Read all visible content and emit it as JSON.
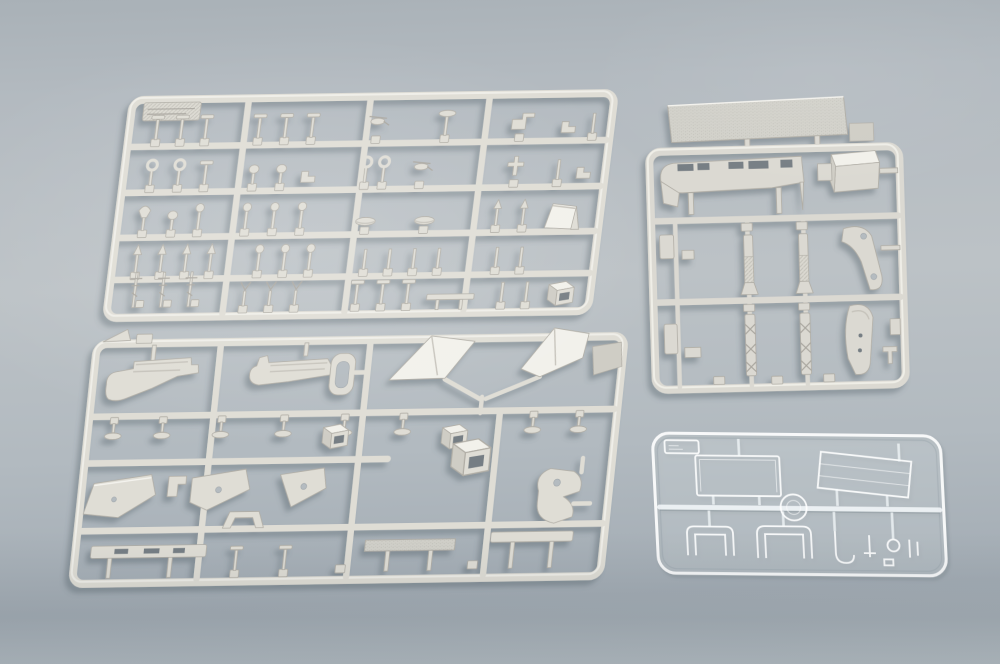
{
  "scene": {
    "title": "Plastic model kit sprues photo",
    "description": "Top-down photograph of four injection-moulded styrene sprues (parts frames) for a warship model kit on a blue-grey surface: a large sprue of small fittings at top left, a large sprue of superstructure parts at bottom left, a sprue of deck and hull parts at top right, and a small transparent clear-parts sprue at bottom right.",
    "background": {
      "top": "#a9b1b7",
      "middle": "#bcc2c6",
      "bottom": "#a3acb4"
    },
    "colors": {
      "plastic": "#dfddd5",
      "plastic_hi": "#f2f1eb",
      "plastic_mid": "#cfcdc5",
      "plastic_shadow": "#b2afa7",
      "outline": "#b0ada5",
      "opening": "#767e84",
      "hole": "#b4bbc0",
      "clear_stroke": "rgba(255,255,255,0.9)"
    },
    "sprues": [
      {
        "id": "A",
        "name": "small fittings sprue",
        "position": "top left",
        "material": "grey styrene",
        "layout": "5 rows x 4 columns of small posts, masts, balls and fittings",
        "parts_approx": 55,
        "label_tab": true
      },
      {
        "id": "B",
        "name": "superstructure parts sprue",
        "position": "bottom left",
        "material": "grey styrene",
        "notable_parts": [
          "two large superstructure side pieces",
          "two bright funnel wedges joined in a V",
          "pointed bow wedge",
          "flat triangular panels with holes",
          "long deck strips"
        ]
      },
      {
        "id": "C",
        "name": "deck and hull parts sprue",
        "position": "top right",
        "material": "grey styrene",
        "notable_parts": [
          "textured deck plank attached above the frame",
          "slotted hull side piece",
          "box structure",
          "two finned launcher parts",
          "two lattice mast parts",
          "curved davit with holes",
          "ship's boat hull"
        ]
      },
      {
        "id": "D",
        "name": "clear parts sprue",
        "position": "bottom right",
        "material": "transparent styrene",
        "notable_parts": [
          "rectangular window panel",
          "angled bridge glazing panel",
          "two windscreen frames",
          "round port",
          "hook piece"
        ],
        "label_tab": true
      }
    ]
  },
  "sprue1": {
    "rows": [
      {
        "y": 47,
        "items": [
          {
            "x": 28,
            "g": "tee"
          },
          {
            "x": 53,
            "g": "tee"
          },
          {
            "x": 78,
            "g": "tee"
          },
          {
            "x": 132,
            "g": "tee"
          },
          {
            "x": 159,
            "g": "tee"
          },
          {
            "x": 186,
            "g": "tee"
          },
          {
            "x": 252,
            "g": "heli"
          },
          {
            "x": 322,
            "g": "oval"
          },
          {
            "x": 398,
            "g": "gun"
          },
          {
            "x": 447,
            "g": "zig"
          },
          {
            "x": 472,
            "g": "post"
          }
        ]
      },
      {
        "y": 93,
        "items": [
          {
            "x": 28,
            "g": "ring"
          },
          {
            "x": 56,
            "g": "ring"
          },
          {
            "x": 83,
            "g": "tee"
          },
          {
            "x": 132,
            "g": "blob"
          },
          {
            "x": 160,
            "g": "blob"
          },
          {
            "x": 188,
            "g": "zig"
          },
          {
            "x": 246,
            "g": "ring"
          },
          {
            "x": 264,
            "g": "ring"
          },
          {
            "x": 302,
            "g": "heli"
          },
          {
            "x": 398,
            "g": "cross"
          },
          {
            "x": 442,
            "g": "post"
          },
          {
            "x": 468,
            "g": "zig"
          }
        ]
      },
      {
        "y": 138,
        "items": [
          {
            "x": 26,
            "g": "fish"
          },
          {
            "x": 55,
            "g": "blob"
          },
          {
            "x": 82,
            "g": "ball"
          },
          {
            "x": 130,
            "g": "ball"
          },
          {
            "x": 158,
            "g": "ball"
          },
          {
            "x": 186,
            "g": "ball"
          },
          {
            "x": 252,
            "g": "boat"
          },
          {
            "x": 312,
            "g": "boat"
          },
          {
            "x": 385,
            "g": "arrow"
          },
          {
            "x": 412,
            "g": "arrow"
          },
          {
            "x": 452,
            "g": "trap3d"
          }
        ]
      },
      {
        "y": 180,
        "items": [
          {
            "x": 24,
            "g": "spear"
          },
          {
            "x": 49,
            "g": "spear"
          },
          {
            "x": 74,
            "g": "spear"
          },
          {
            "x": 99,
            "g": "spear"
          },
          {
            "x": 148,
            "g": "ball"
          },
          {
            "x": 174,
            "g": "ball"
          },
          {
            "x": 200,
            "g": "ball"
          },
          {
            "x": 256,
            "g": "post"
          },
          {
            "x": 281,
            "g": "post"
          },
          {
            "x": 306,
            "g": "post"
          },
          {
            "x": 331,
            "g": "post"
          },
          {
            "x": 390,
            "g": "post"
          },
          {
            "x": 415,
            "g": "post"
          }
        ]
      },
      {
        "y": 215,
        "items": [
          {
            "x": 26,
            "g": "mast"
          },
          {
            "x": 54,
            "g": "mast"
          },
          {
            "x": 82,
            "g": "mast"
          },
          {
            "x": 138,
            "g": "y"
          },
          {
            "x": 164,
            "g": "y"
          },
          {
            "x": 190,
            "g": "y"
          },
          {
            "x": 252,
            "g": "tee"
          },
          {
            "x": 278,
            "g": "tee"
          },
          {
            "x": 304,
            "g": "tee"
          },
          {
            "x": 348,
            "g": "strip"
          },
          {
            "x": 400,
            "g": "post"
          },
          {
            "x": 425,
            "g": "post"
          },
          {
            "x": 458,
            "g": "box3d"
          }
        ]
      }
    ]
  }
}
